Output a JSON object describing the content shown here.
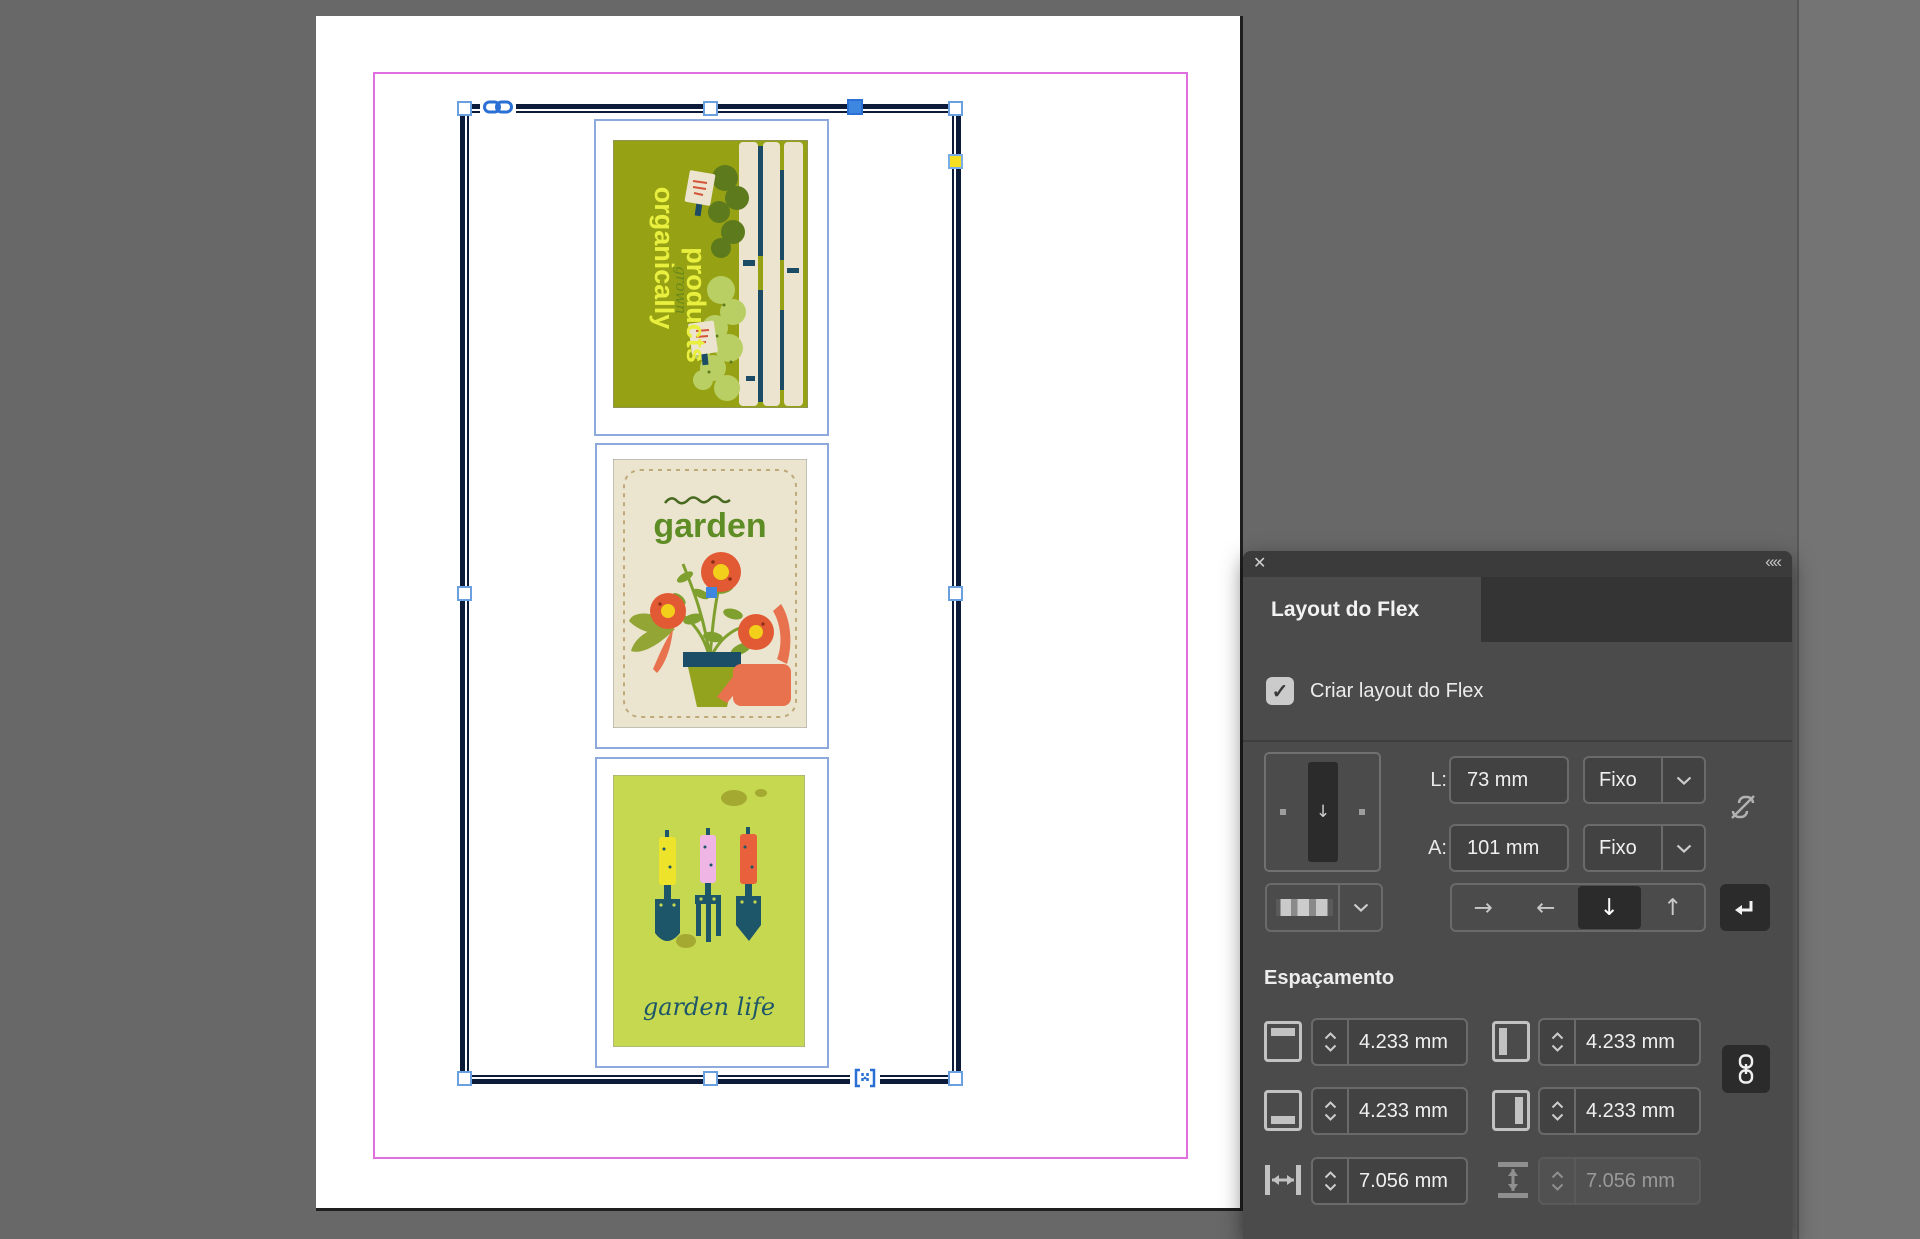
{
  "panel": {
    "icons": {
      "close": "✕",
      "collapse": "««",
      "check": "✓",
      "preview_direction_arrow": "↓"
    },
    "tab": {
      "title": "Layout do Flex"
    },
    "checkbox": {
      "label": "Criar layout do Flex",
      "checked": true
    },
    "fields": {
      "width_label": "L:",
      "width_value": "73 mm",
      "width_mode": "Fixo",
      "height_label": "A:",
      "height_value": "101 mm",
      "height_mode": "Fixo"
    },
    "direction": {
      "right": "→",
      "left": "←",
      "down": "↓",
      "up": "↑",
      "selected": "down"
    },
    "spacing": {
      "heading": "Espaçamento",
      "top_value": "4.233 mm",
      "left_value": "4.233 mm",
      "bottom_value": "4.233 mm",
      "right_value": "4.233 mm",
      "gap_horizontal_value": "7.056 mm",
      "gap_vertical_value": "7.056 mm",
      "gap_vertical_disabled": true
    }
  },
  "canvas": {
    "poster_organic": {
      "line1": "organically",
      "line2": "grown",
      "line3": "products"
    },
    "poster_garden": {
      "title": "garden"
    },
    "poster_tools": {
      "caption": "garden life"
    }
  },
  "colors": {
    "pasteboard": "#686868",
    "margin_guide": "#df6ede",
    "frame_stroke": "#0d1b3a",
    "subframe_stroke": "#8ea9dc",
    "selection_blue": "#3d87e0",
    "yellow_handle": "#f6df1e",
    "link_blue": "#2a6fd4",
    "panel_bg": "#4b4b4b",
    "poster1_bg": "#96a213",
    "poster2_bg": "#ebe4cf",
    "poster3_bg": "#c6d84f"
  }
}
